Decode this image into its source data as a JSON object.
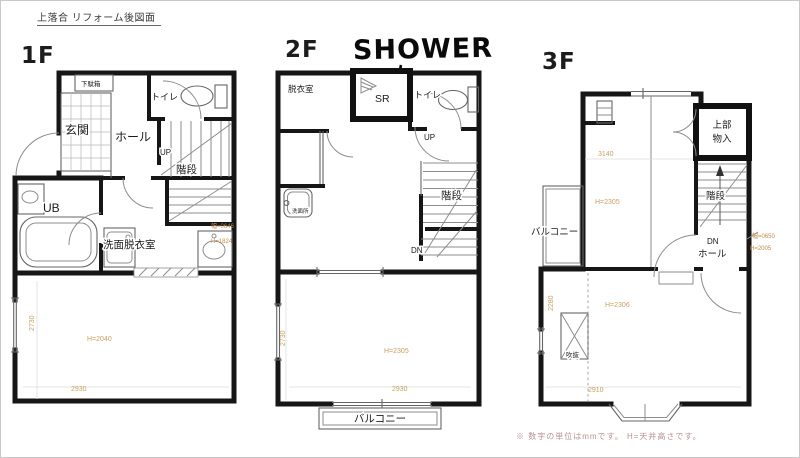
{
  "title": "上落合 リフォーム後図面",
  "footnote": "※ 数字の単位はmmです。 H=天井高さです。",
  "colors": {
    "wall": "#161616",
    "thin_line": "#8d8d8d",
    "dim_text": "#c9a063",
    "footnote": "#b89090",
    "handwriting": "#0a0a0a"
  },
  "floor1": {
    "label": "1F",
    "rooms": {
      "shoe_cabinet": "下駄箱",
      "entrance": "玄関",
      "hall": "ホール",
      "toilet": "トイレ",
      "up": "UP",
      "stairs": "階段",
      "bath": "UB",
      "washroom": "洗面脱衣室"
    },
    "dims": {
      "door_width": "幅=0646",
      "door_height": "H=1824",
      "ceiling": "H=2040",
      "width": "2930",
      "depth": "2730"
    }
  },
  "floor2": {
    "label": "2F",
    "handwriting": "SHOWER",
    "rooms": {
      "dressing": "脱衣室",
      "shower_room": "SR",
      "toilet": "トイレ",
      "wash": "洗面所",
      "up": "UP",
      "stairs": "階段",
      "dn": "DN",
      "balcony": "バルコニー"
    },
    "dims": {
      "ceiling": "H=2305",
      "width": "2930",
      "depth": "2730"
    }
  },
  "floor3": {
    "label": "3F",
    "rooms": {
      "storage_line1": "上部",
      "storage_line2": "物入",
      "stairs": "階段",
      "dn": "DN",
      "hall": "ホール",
      "balcony": "バルコニー",
      "void": "吹抜"
    },
    "dims": {
      "upper_width": "3140",
      "upper_ceiling": "H=2305",
      "lower_ceiling": "H=2306",
      "lower_width": "2910",
      "depth": "2280",
      "door_width": "幅=0650",
      "door_height": "H=2005"
    }
  }
}
